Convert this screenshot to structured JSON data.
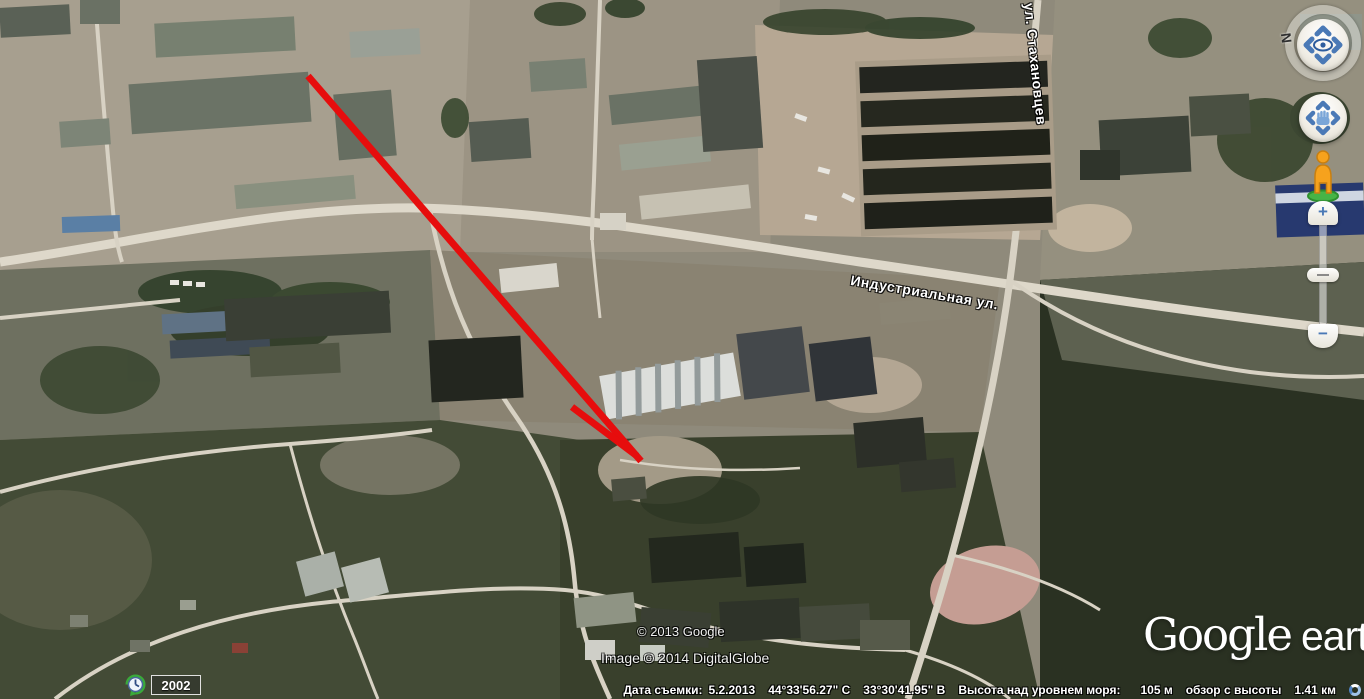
{
  "app": "Google Earth",
  "map": {
    "street_labels": [
      {
        "text": "Индустриальная ул."
      },
      {
        "text": "ул. Стахановцев"
      }
    ],
    "copyright_line1": "© 2013 Google",
    "copyright_line2": "Image © 2014 DigitalGlobe",
    "logo": {
      "part1": "Google",
      "part2": "earth"
    },
    "annotation_arrow": {
      "color": "#e60d0d",
      "shaft_points": "308,76 641,461",
      "barb_points": "572,407 637,456",
      "stroke_width": "7"
    }
  },
  "time_control": {
    "year": "2002",
    "icon": "history-clock-icon"
  },
  "navigation": {
    "north_label": "N",
    "look_icon": "eye-icon",
    "move_icon": "pan-hand-icon",
    "pegman_icon": "street-view-pegman",
    "zoom_in_label": "+",
    "zoom_out_label": "−"
  },
  "status_bar": {
    "capture_date_label": "Дата съемки:",
    "capture_date": "5.2.2013",
    "latitude": "44°33'56.27\" С",
    "longitude": "33°30'41.95\" В",
    "elevation_label": "Высота над уровнем моря:",
    "elevation_value": "105 м",
    "eye_altitude_label": "обзор с высоты",
    "eye_altitude_value": "1.41 км",
    "spinner_icon": "streaming-spinner-icon"
  }
}
